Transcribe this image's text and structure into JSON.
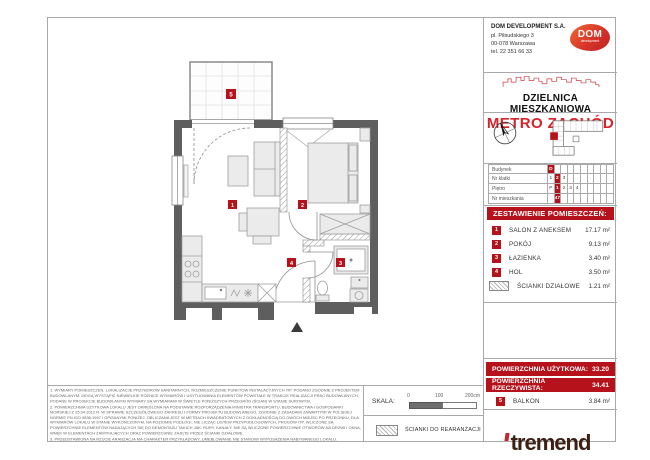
{
  "header": {
    "company": {
      "name": "DOM DEVELOPMENT S.A.",
      "address1": "pl. Piłsudskiego 3",
      "address2": "00-078 Warszawa",
      "phone": "tel. 22 351 66 33"
    },
    "logo": {
      "text": "DOM",
      "subtext": "development"
    },
    "district": "DZIELNICA MIESZKANIOWA",
    "project": "METRO ZACHÓD"
  },
  "unit_table": {
    "rows": [
      {
        "label": "Budynek",
        "cells": [
          "D",
          "",
          "",
          "",
          "",
          "",
          "",
          "",
          "",
          ""
        ],
        "selected": 0
      },
      {
        "label": "Nr klatki",
        "cells": [
          "1",
          "2",
          "3",
          "",
          "",
          "",
          "",
          "",
          "",
          ""
        ],
        "selected": 1
      },
      {
        "label": "Piętro",
        "cells": [
          "P",
          "1",
          "2",
          "3",
          "4",
          "",
          "",
          "",
          "",
          ""
        ],
        "selected": 1
      },
      {
        "label": "Nr mieszkania",
        "cells": [
          "",
          "47",
          "",
          "",
          "",
          "",
          "",
          "",
          "",
          ""
        ],
        "selected": 1
      }
    ]
  },
  "rooms": {
    "title": "ZESTAWIENIE POMIESZCZEŃ:",
    "items": [
      {
        "no": "1",
        "name": "SALON Z ANEKSEM",
        "area": "17.17 m²"
      },
      {
        "no": "2",
        "name": "POKÓJ",
        "area": "9.13 m²"
      },
      {
        "no": "3",
        "name": "ŁAZIENKA",
        "area": "3.40 m²"
      },
      {
        "no": "4",
        "name": "HOL",
        "area": "3.50 m²"
      }
    ],
    "partitions": {
      "name": "ŚCIANKI DZIAŁOWE",
      "area": "1.21 m²"
    }
  },
  "areas": {
    "usable_label": "POWIERZCHNIA UŻYTKOWA:",
    "usable_value": "33.20",
    "actual_label": "POWIERZCHNIA RZECZYWISTA:",
    "actual_value": "34.41",
    "balcony": {
      "no": "5",
      "name": "BALKON",
      "area": "3.84 m²"
    }
  },
  "plan": {
    "markers": [
      "1",
      "2",
      "3",
      "4",
      "5"
    ]
  },
  "footer": {
    "notes": [
      "1. WYMIARY POMIESZCZEŃ, LOKALIZACJE PRZYBORÓW SANITARNYCH, ROZMIESZCZENIE PUNKTÓW INSTALACYJNYCH ITP. PODANO ZGODNIE Z PROJEKTEM BUDOWLANYM. MOGĄ WYSTĄPIĆ NIEWIELKIE RÓŻNICE WYMIARÓW I USYTUOWANIA ELEMENTÓW POWSTAŁE W TRAKCIE REALIZACJI PRAC BUDOWLANYCH, PODANE W PROJEKCIE BUDOWLANYM WYMIARY SĄ WYMIARAMI W ŚWIETLE PONIŻSZYCH PRZEGRÓD (ŚCIAN) W STANIE SUROWYM.",
      "2. POWIERZCHNIA UŻYTKOWA LOKALU JEST OKREŚLONA NA PODSTAWIE ROZPORZĄDZENIA MINISTRA TRANSPORTU, BUDOWNICTWA I GOSPODARKI MORSKIEJ Z 25.04.2012 R. W SPRAWIE SZCZEGÓŁOWEGO ZAKRESU I FORMY PROJEKTU BUDOWLANEGO, ZGODNIE Z ZASADAMI ZAWARTYMI W POLSKIEJ NORMIE PN-ISO 9836:1997 I OPISANYMI PONIŻEJ. OBLICZANA JEST W METRACH KWADRATOWYCH Z DOKŁADNOŚCIĄ DO DWÓCH MIEJSC PO PRZECINKU, DLA WYMIARÓW LOKALU W STANIE WYKOŃCZONYM, NA POZIOMIE PODŁOGI, NIE LICZĄC LISTEW PRZYPODŁOGOWYCH, PROGÓW ITP. WLICZONE SĄ POWIERZCHNIE ELEMENTÓW NADAJĄCYCH SIĘ DO DEMONTAŻU TAKICH JAK: RURY, KANAŁY. NIE SĄ WLICZONE POWIERZCHNIE OTWORÓW NA DRZWI I OKNA, WNĘK W ELEMENTACH ZAMYKAJĄCYCH ORAZ POWIERZCHNIE ZAJĘTE PRZEZ ŚCIANKI DZIAŁOWE.",
      "3. PRZEDSTAWIONA NA RZUCIE ARANŻACJA MA CHARAKTER PRZYKŁADOWY, UMEBLOWANIE NIE STANOWI WYPOSAŻENIA NABYWANEGO LOKALU."
    ],
    "scale": {
      "label": "SKALA:",
      "ticks": [
        "0",
        "100",
        "200cm"
      ]
    },
    "legend": {
      "rearrangement": "ŚCIANKI DO REARANŻACJI"
    },
    "brand": "tremend"
  },
  "colors": {
    "accent_red": "#b5121b",
    "metro_red": "#d6232b",
    "tremend_brown": "#3b2013",
    "wall_gray": "#5e5e5e"
  }
}
